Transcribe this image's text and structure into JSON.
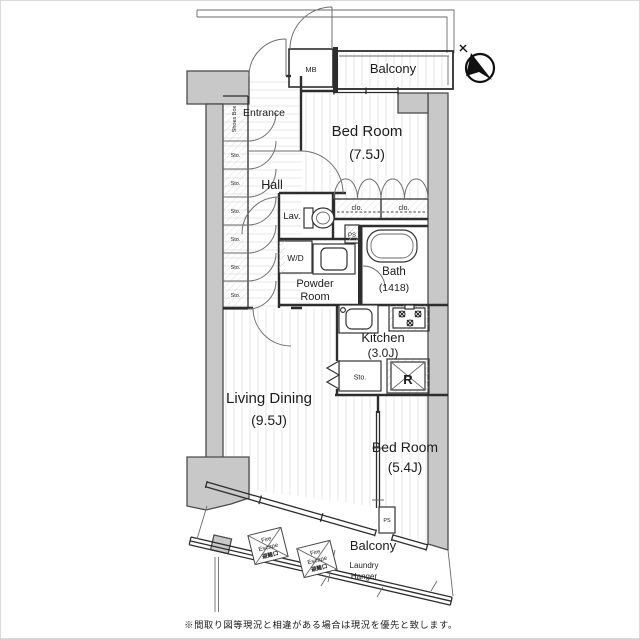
{
  "floorplan": {
    "compass": "north-arrow",
    "rooms": {
      "entrance": {
        "label": "Entrance"
      },
      "hall": {
        "label": "Hall"
      },
      "bedroom1": {
        "label": "Bed Room",
        "size": "(7.5J)"
      },
      "lavatory": {
        "label": "Lav."
      },
      "powder_room": {
        "label_line1": "Powder",
        "label_line2": "Room"
      },
      "bath": {
        "label": "Bath",
        "size": "(1418)"
      },
      "kitchen": {
        "label": "Kitchen",
        "size": "(3.0J)"
      },
      "living_dining": {
        "label": "Living Dining",
        "size": "(9.5J)"
      },
      "bedroom2": {
        "label": "Bed Room",
        "size": "(5.4J)"
      },
      "balcony_top": {
        "label": "Balcony"
      },
      "balcony_bottom": {
        "label": "Balcony"
      }
    },
    "fixtures": {
      "meter_box": "MB",
      "shoes_box": "Shoes Box",
      "storage": "Sto.",
      "closet": "clo.",
      "pipe_space": "PS",
      "washer_dryer": "W/D",
      "refrigerator": "R",
      "laundry_hanger_line1": "Laundry",
      "laundry_hanger_line2": "Hanger",
      "fire_escape_line1": "Fire",
      "fire_escape_line2": "Escape",
      "fire_escape_jp": "避難口"
    },
    "note": "※間取り図等現況と相違がある場合は現況を優先と致します。"
  }
}
